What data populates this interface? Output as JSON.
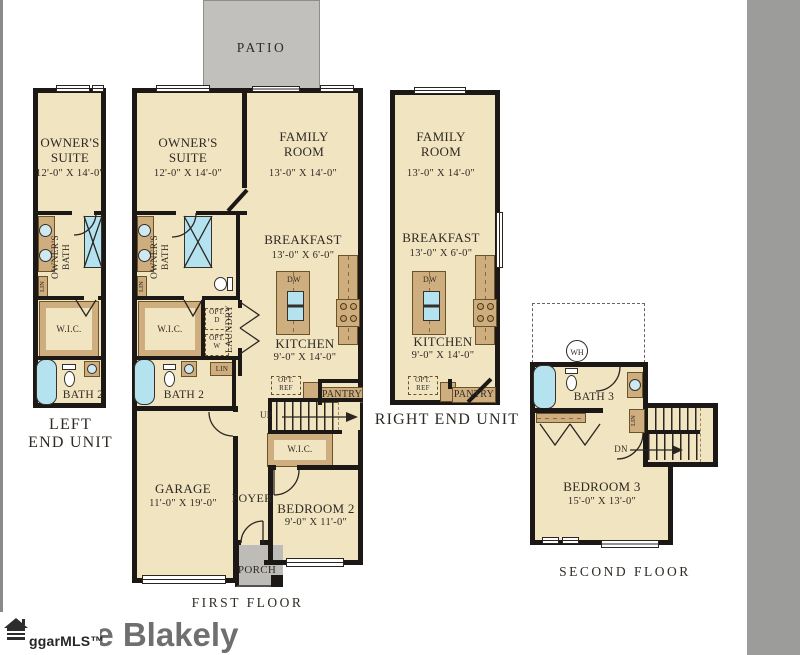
{
  "branding": {
    "title": "The Blakely",
    "mls_logo": "ggarMLS™"
  },
  "floor_titles": {
    "first": "FIRST FLOOR",
    "second": "SECOND FLOOR"
  },
  "unit_titles": {
    "left_line1": "LEFT",
    "left_line2": "END UNIT",
    "right": "RIGHT END UNIT"
  },
  "outdoor": {
    "patio": "PATIO",
    "porch": "PORCH"
  },
  "rooms": {
    "owners_suite": {
      "name": "OWNER'S SUITE",
      "dims": "12'-0\" X 14'-0\""
    },
    "family_room": {
      "name": "FAMILY ROOM",
      "dims": "13'-0\" X 14'-0\""
    },
    "breakfast": {
      "name": "BREAKFAST",
      "dims": "13'-0\" X 6'-0\""
    },
    "kitchen": {
      "name": "KITCHEN",
      "dims": "9'-0\" X 14'-0\""
    },
    "garage": {
      "name": "GARAGE",
      "dims": "11'-0\" X 19'-0\""
    },
    "bedroom2": {
      "name": "BEDROOM 2",
      "dims": "9'-0\" X 11'-0\""
    },
    "bedroom3": {
      "name": "BEDROOM 3",
      "dims": "15'-0\" X 13'-0\""
    },
    "owners_bath": {
      "name": "OWNER'S BATH"
    },
    "bath2": {
      "name": "BATH 2"
    },
    "bath3": {
      "name": "BATH 3"
    },
    "laundry": {
      "name": "LAUNDRY"
    },
    "wic": {
      "name": "W.I.C."
    },
    "foyer": {
      "name": "FOYER"
    },
    "pantry": {
      "name": "PANTRY"
    }
  },
  "annotations": {
    "up": "UP",
    "dn": "DN",
    "dw": "DW",
    "wh": "WH",
    "lin": "LIN",
    "opt_ref_line1": "OPT.",
    "opt_ref_line2": "REF",
    "opt_d_line1": "OPT.",
    "opt_d_line2": "D",
    "opt_w_line1": "OPT.",
    "opt_w_line2": "W"
  },
  "colors": {
    "floor": "#F1E4C1",
    "walls": "#1B1815",
    "cabinetry": "#CEAE7E",
    "plumbing_blue": "#B5E2EF",
    "patio_gray": "#C1C0BD",
    "sidebar_gray": "#9C9C9A",
    "title_gray": "#6F6F6F"
  }
}
